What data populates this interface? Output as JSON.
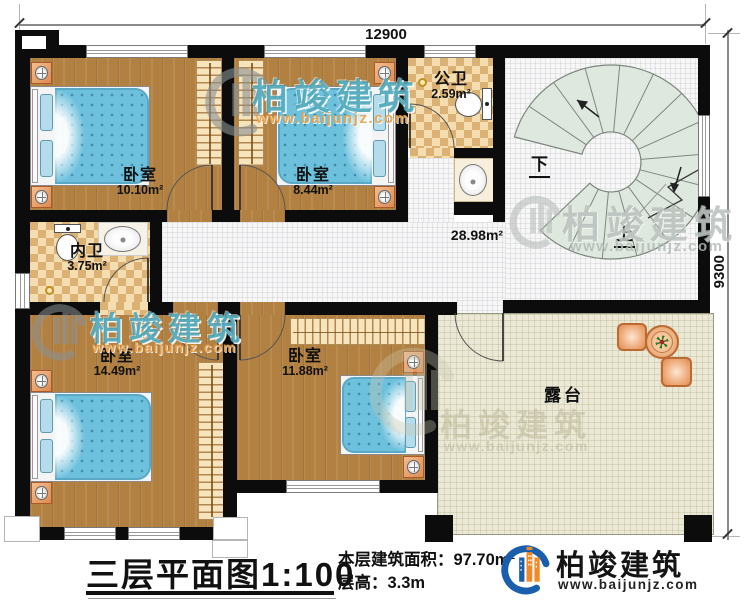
{
  "dimensions": {
    "width_label": "12900",
    "height_label": "9300"
  },
  "rooms": {
    "bedroom_top_left": {
      "name": "卧室",
      "area": "10.10m²"
    },
    "bedroom_top_mid": {
      "name": "卧室",
      "area": "8.44m²"
    },
    "public_bathroom": {
      "name": "公卫",
      "area": "2.59m²"
    },
    "inner_bathroom": {
      "name": "内卫",
      "area": "3.75m²"
    },
    "bedroom_bottom_left": {
      "name": "卧室",
      "area": "14.49m²"
    },
    "bedroom_bottom_mid": {
      "name": "卧室",
      "area": "11.88m²"
    },
    "hallway": {
      "area": "28.98m²"
    },
    "terrace": {
      "name": "露台"
    }
  },
  "stairs": {
    "down_label": "下",
    "up_label": "上"
  },
  "title_block": {
    "title": "三层平面图",
    "scale": "1:100",
    "area_label": "本层建筑面积：",
    "area_value": "97.70m²",
    "floor_height_label": "层高：",
    "floor_height_value": "3.3m"
  },
  "brand": {
    "name": "柏竣建筑",
    "website": "www.baijunjz.com"
  },
  "watermark": {
    "name": "柏竣建筑",
    "website": "www.baijunjz.com"
  },
  "colors": {
    "brand_blue": "#1a5fad",
    "brand_orange": "#f08a28",
    "wall_black": "#0c0c0c",
    "wood_floor": "#b28142",
    "bed_blue": "#6ec1dd",
    "bath_tile": "#edd29c",
    "terrace_floor": "#ebe9d6",
    "stair_tread": "#dfe8df",
    "watermark_teal": "#3a9eb2"
  }
}
